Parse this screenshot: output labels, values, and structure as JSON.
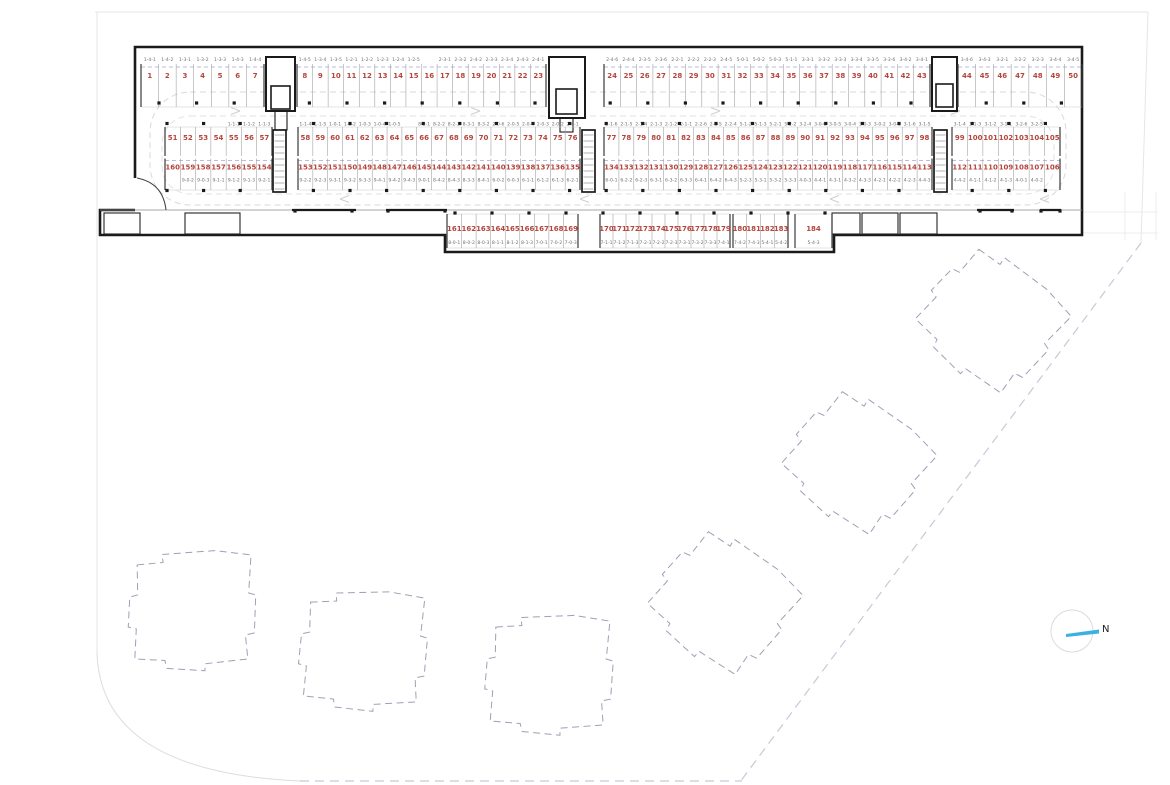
{
  "north_label": "N",
  "colors": {
    "space_number": "#b5453c",
    "unit_label": "#6f6f6f",
    "walls": "#1a1a1a",
    "future_building_dash": "#9aa2b4",
    "driveway_dash": "#d9d9d9",
    "unit_boundary_dash": "#b6bdde",
    "north_arrow": "#3ab1e2"
  },
  "parking": {
    "rows": [
      {
        "name": "top-row",
        "segments": [
          {
            "spaces": [
              [
                "1",
                "1-4-1"
              ],
              [
                "2",
                "1-4-2"
              ],
              [
                "3",
                "1-3-1"
              ],
              [
                "4",
                "1-3-2"
              ],
              [
                "5",
                "1-3-3"
              ],
              [
                "6",
                "1-4-3"
              ],
              [
                "7",
                "1-4-4"
              ]
            ]
          },
          {
            "spaces": [
              [
                "8",
                "1-4-5"
              ],
              [
                "9",
                "1-3-4"
              ],
              [
                "10",
                "1-3-5"
              ],
              [
                "11",
                "1-2-1"
              ],
              [
                "12",
                "1-2-2"
              ],
              [
                "13",
                "1-2-3"
              ],
              [
                "14",
                "1-2-4"
              ],
              [
                "15",
                "1-2-5"
              ],
              [
                "16",
                ""
              ],
              [
                "17",
                "2-3-1"
              ],
              [
                "18",
                "2-3-2"
              ],
              [
                "19",
                "2-4-2"
              ],
              [
                "20",
                "2-3-3"
              ],
              [
                "21",
                "2-3-4"
              ],
              [
                "22",
                "2-4-3"
              ],
              [
                "23",
                "2-4-1"
              ]
            ]
          },
          {
            "spaces": [
              [
                "24",
                "2-4-6"
              ],
              [
                "25",
                "2-4-4"
              ],
              [
                "26",
                "2-3-5"
              ],
              [
                "27",
                "2-3-6"
              ],
              [
                "28",
                "2-2-1"
              ],
              [
                "29",
                "2-2-2"
              ],
              [
                "30",
                "2-2-3"
              ],
              [
                "31",
                "2-4-5"
              ],
              [
                "32",
                "5-0-1"
              ],
              [
                "33",
                "5-0-2"
              ],
              [
                "34",
                "5-0-3"
              ],
              [
                "35",
                "5-1-1"
              ],
              [
                "36",
                "3-3-1"
              ],
              [
                "37",
                "3-3-2"
              ],
              [
                "38",
                "3-3-3"
              ],
              [
                "39",
                "3-3-4"
              ],
              [
                "40",
                "3-3-5"
              ],
              [
                "41",
                "3-3-6"
              ],
              [
                "42",
                "3-4-2"
              ],
              [
                "43",
                "3-4-1"
              ]
            ]
          },
          {
            "spaces": [
              [
                "44",
                "3-4-6"
              ],
              [
                "45",
                "3-4-3"
              ],
              [
                "46",
                "3-2-1"
              ],
              [
                "47",
                "3-2-2"
              ],
              [
                "48",
                "3-2-3"
              ],
              [
                "49",
                "3-4-4"
              ],
              [
                "50",
                "3-4-5"
              ]
            ]
          }
        ]
      },
      {
        "name": "middle-upper-row",
        "segments": [
          {
            "spaces": [
              [
                "51",
                ""
              ],
              [
                "52",
                ""
              ],
              [
                "53",
                ""
              ],
              [
                "54",
                ""
              ],
              [
                "55",
                "1-1-1"
              ],
              [
                "56",
                "1-1-2"
              ],
              [
                "57",
                "1-1-3"
              ]
            ]
          },
          {
            "spaces": [
              [
                "58",
                "1-1-4"
              ],
              [
                "59",
                "1-1-5"
              ],
              [
                "60",
                "1-0-1"
              ],
              [
                "61",
                "1-0-2"
              ],
              [
                "62",
                "1-0-3"
              ],
              [
                "63",
                "1-0-4"
              ],
              [
                "64",
                "1-0-5"
              ],
              [
                "65",
                ""
              ],
              [
                "66",
                "8-2-1"
              ],
              [
                "67",
                "8-2-2"
              ],
              [
                "68",
                "8-2-3"
              ],
              [
                "69",
                "8-3-1"
              ],
              [
                "70",
                "8-3-2"
              ],
              [
                "71",
                "2-0-6"
              ],
              [
                "72",
                "2-0-5"
              ],
              [
                "73",
                "2-0-4"
              ],
              [
                "74",
                "2-0-3"
              ],
              [
                "75",
                "2-0-2"
              ],
              [
                "76",
                "2-0-1"
              ]
            ]
          },
          {
            "spaces": [
              [
                "77",
                "2-1-6"
              ],
              [
                "78",
                "2-1-5"
              ],
              [
                "79",
                "2-1-4"
              ],
              [
                "80",
                "2-1-3"
              ],
              [
                "81",
                "2-1-2"
              ],
              [
                "82",
                "2-1-1"
              ],
              [
                "83",
                "2-2-6"
              ],
              [
                "84",
                "2-2-5"
              ],
              [
                "85",
                "2-2-4"
              ],
              [
                "86",
                "5-1-2"
              ],
              [
                "87",
                "5-1-3"
              ],
              [
                "88",
                "5-2-1"
              ],
              [
                "89",
                "5-2-2"
              ],
              [
                "90",
                "3-2-4"
              ],
              [
                "91",
                "3-0-6"
              ],
              [
                "92",
                "3-0-5"
              ],
              [
                "93",
                "3-0-4"
              ],
              [
                "94",
                "3-0-3"
              ],
              [
                "95",
                "3-0-2"
              ],
              [
                "96",
                "3-0-1"
              ],
              [
                "97",
                "3-1-6"
              ],
              [
                "98",
                "3-1-5"
              ]
            ]
          },
          {
            "spaces": [
              [
                "99",
                "3-1-4"
              ],
              [
                "100",
                "3-1-3"
              ],
              [
                "101",
                "3-1-2"
              ],
              [
                "102",
                "3-1-1"
              ],
              [
                "103",
                "3-2-6"
              ],
              [
                "104",
                "3-2-5"
              ],
              [
                "105",
                ""
              ]
            ]
          }
        ]
      },
      {
        "name": "middle-lower-row",
        "segments": [
          {
            "spaces": [
              [
                "160",
                ""
              ],
              [
                "159",
                "9-0-2"
              ],
              [
                "158",
                "9-0-3"
              ],
              [
                "157",
                "9-1-1"
              ],
              [
                "156",
                "9-1-2"
              ],
              [
                "155",
                "9-1-3"
              ],
              [
                "154",
                "9-2-1"
              ]
            ]
          },
          {
            "spaces": [
              [
                "153",
                "9-2-2"
              ],
              [
                "152",
                "9-2-3"
              ],
              [
                "151",
                "9-3-1"
              ],
              [
                "150",
                "9-3-2"
              ],
              [
                "149",
                "9-3-3"
              ],
              [
                "148",
                "9-4-1"
              ],
              [
                "147",
                "9-4-2"
              ],
              [
                "146",
                "9-4-3"
              ],
              [
                "145",
                "9-0-1"
              ],
              [
                "144",
                "8-4-2"
              ],
              [
                "143",
                "8-4-3"
              ],
              [
                "142",
                "8-3-3"
              ],
              [
                "141",
                "8-4-1"
              ],
              [
                "140",
                "6-0-2"
              ],
              [
                "139",
                "6-0-3"
              ],
              [
                "138",
                "6-1-1"
              ],
              [
                "137",
                "6-1-2"
              ],
              [
                "136",
                "6-1-3"
              ],
              [
                "135",
                "6-2-1"
              ]
            ]
          },
          {
            "spaces": [
              [
                "134",
                "6-0-1"
              ],
              [
                "133",
                "6-2-2"
              ],
              [
                "132",
                "6-2-3"
              ],
              [
                "131",
                "6-3-1"
              ],
              [
                "130",
                "6-3-2"
              ],
              [
                "129",
                "6-3-3"
              ],
              [
                "128",
                "6-4-1"
              ],
              [
                "127",
                "6-4-2"
              ],
              [
                "126",
                "6-4-3"
              ],
              [
                "125",
                "5-2-3"
              ],
              [
                "124",
                "5-3-1"
              ],
              [
                "123",
                "5-3-2"
              ],
              [
                "122",
                "5-3-3"
              ],
              [
                "121",
                "4-0-3"
              ],
              [
                "120",
                "4-4-1"
              ],
              [
                "119",
                "4-3-1"
              ],
              [
                "118",
                "4-3-2"
              ],
              [
                "117",
                "4-3-3"
              ],
              [
                "116",
                "4-2-1"
              ],
              [
                "115",
                "4-2-2"
              ],
              [
                "114",
                "4-2-3"
              ],
              [
                "113",
                "4-4-3"
              ]
            ]
          },
          {
            "spaces": [
              [
                "112",
                "4-4-2"
              ],
              [
                "111",
                "4-1-1"
              ],
              [
                "110",
                "4-1-2"
              ],
              [
                "109",
                "4-1-3"
              ],
              [
                "108",
                "4-0-1"
              ],
              [
                "107",
                "4-0-2"
              ],
              [
                "106",
                ""
              ]
            ]
          }
        ]
      },
      {
        "name": "bottom-row",
        "segments": [
          {
            "spaces": [
              [
                "161",
                "8-0-1"
              ],
              [
                "162",
                "8-0-2"
              ],
              [
                "163",
                "8-0-3"
              ],
              [
                "164",
                "8-1-1"
              ],
              [
                "165",
                "8-1-2"
              ],
              [
                "166",
                "8-1-3"
              ],
              [
                "167",
                "7-0-1"
              ],
              [
                "168",
                "7-0-2"
              ],
              [
                "169",
                "7-0-3"
              ]
            ]
          },
          {
            "spaces": [
              [
                "170",
                "7-1-1"
              ],
              [
                "171",
                "7-1-2"
              ],
              [
                "172",
                "7-1-3"
              ],
              [
                "173",
                "7-2-1"
              ],
              [
                "174",
                "7-2-2"
              ],
              [
                "175",
                "7-2-3"
              ],
              [
                "176",
                "7-3-1"
              ],
              [
                "177",
                "7-3-2"
              ],
              [
                "178",
                "7-3-3"
              ],
              [
                "179",
                "7-4-1"
              ]
            ]
          },
          {
            "spaces": [
              [
                "180",
                "7-4-2"
              ],
              [
                "181",
                "7-4-3"
              ],
              [
                "182",
                "5-4-1"
              ],
              [
                "183",
                "5-4-2"
              ]
            ]
          },
          {
            "spaces": [
              [
                "184",
                "5-4-3"
              ]
            ]
          }
        ]
      }
    ]
  }
}
